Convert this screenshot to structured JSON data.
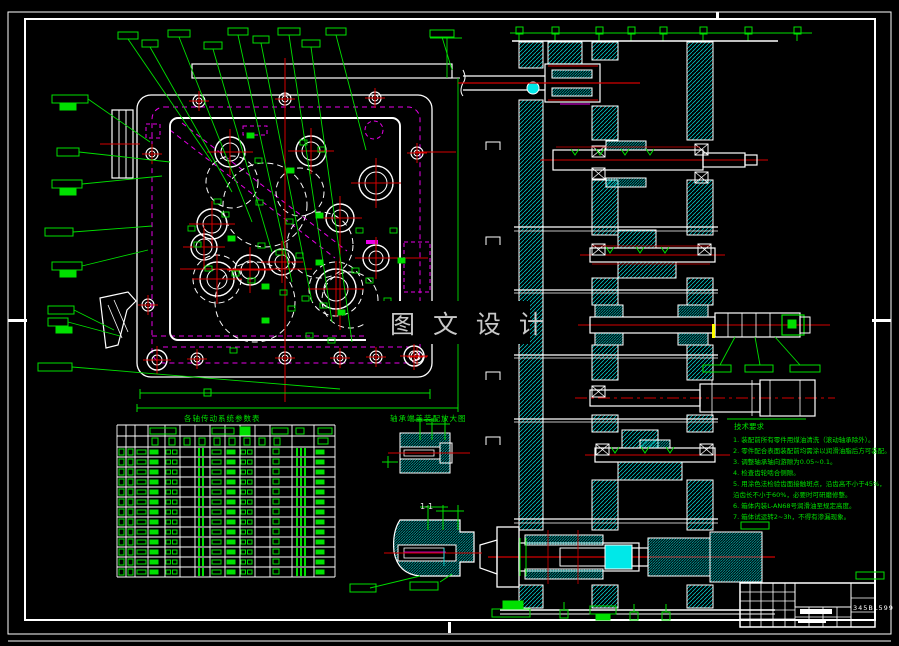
{
  "colors": {
    "background": "#000000",
    "line_white": "#ffffff",
    "callout_green": "#00e000",
    "hidden_magenta": "#e800e8",
    "centerline_red": "#d40000",
    "hatch_cyan": "#00dede",
    "solid_cyan": "#00e8e8",
    "highlight_yellow": "#ffff00",
    "watermark_gray": "#c8c8c8"
  },
  "watermark": {
    "text": "图 文 设 计"
  },
  "tables": {
    "bom_title": "各轴传动系统参数表",
    "detail_title": "轴承端盖装配放大图",
    "section_label": "1-1"
  },
  "notes": {
    "header": "技术要求",
    "lines": [
      "1. 装配前所有零件用煤油清洗（滚动轴承除外）。",
      "2. 零件配合表面装配前均需涂以润滑油脂后方可装配。",
      "3. 调整轴承轴向游隙为0.05~0.1。",
      "4. 检查齿轮啮合侧隙。",
      "5. 用涂色法检验齿面接触斑点，沿齿高不小于45%，",
      "   沿齿长不小于60%，必要时可研磨修整。",
      "6. 箱体内装L-AN68号润滑油至规定高度。",
      "7. 箱体试运转2~3h，不得有渗漏现象。"
    ]
  },
  "title_block": {
    "drawing_no": "345BL599"
  }
}
